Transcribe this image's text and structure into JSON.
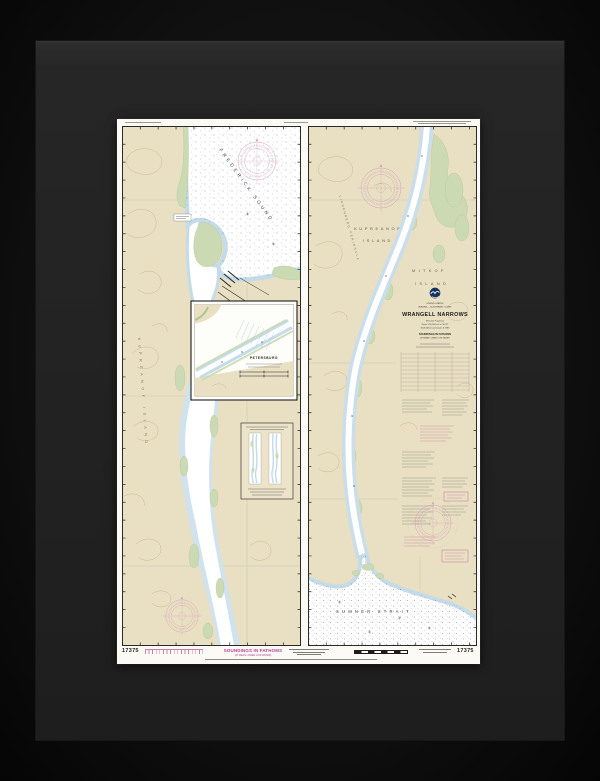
{
  "chart": {
    "number": "17375",
    "title_block": {
      "nation": "UNITED STATES",
      "region": "ALASKA — SOUTHEAST COAST",
      "title": "WRANGELL NARROWS",
      "projection": "Mercator Projection",
      "scale": "Scale 1:20,000 at Lat. 56°37'",
      "datum": "North American Datum of 1983",
      "soundings": "SOUNDINGS IN FATHOMS",
      "soundings_sub": "AT MEAN LOWER LOW WATER"
    },
    "place_labels": {
      "frederick_sound": "FREDERICK SOUND",
      "kupreanof_island_vertical": "KUPREANOF ISLAND",
      "lindenberg_peninsula": "LINDENBERG PENINSULA",
      "kupreanof_line1": "KUPREANOF",
      "kupreanof_line2": "ISLAND",
      "mitkof_line1": "MITKOF",
      "mitkof_line2": "ISLAND",
      "sumner_strait": "SUMNER STRAIT",
      "petersburg": "PETERSBURG"
    },
    "margins": {
      "bottom_left_number": "17375",
      "bottom_right_number": "17375",
      "bottom_center": "SOUNDINGS IN FATHOMS",
      "bottom_center_sub": "(AT MEAN LOWER LOW WATER)"
    },
    "colors": {
      "paper": "#fbfaf4",
      "land_tan": "#e9dfc2",
      "shallow_blue": "#cfe2ee",
      "flats_green": "#cbdab3",
      "compass_magenta": "#d39fba",
      "note_magenta": "#c06aa0",
      "soundings_magenta": "#b73c9e",
      "frame_black": "#0a0a0a",
      "mat_gray": "#242424",
      "contour_brown": "#c9b48d"
    }
  }
}
